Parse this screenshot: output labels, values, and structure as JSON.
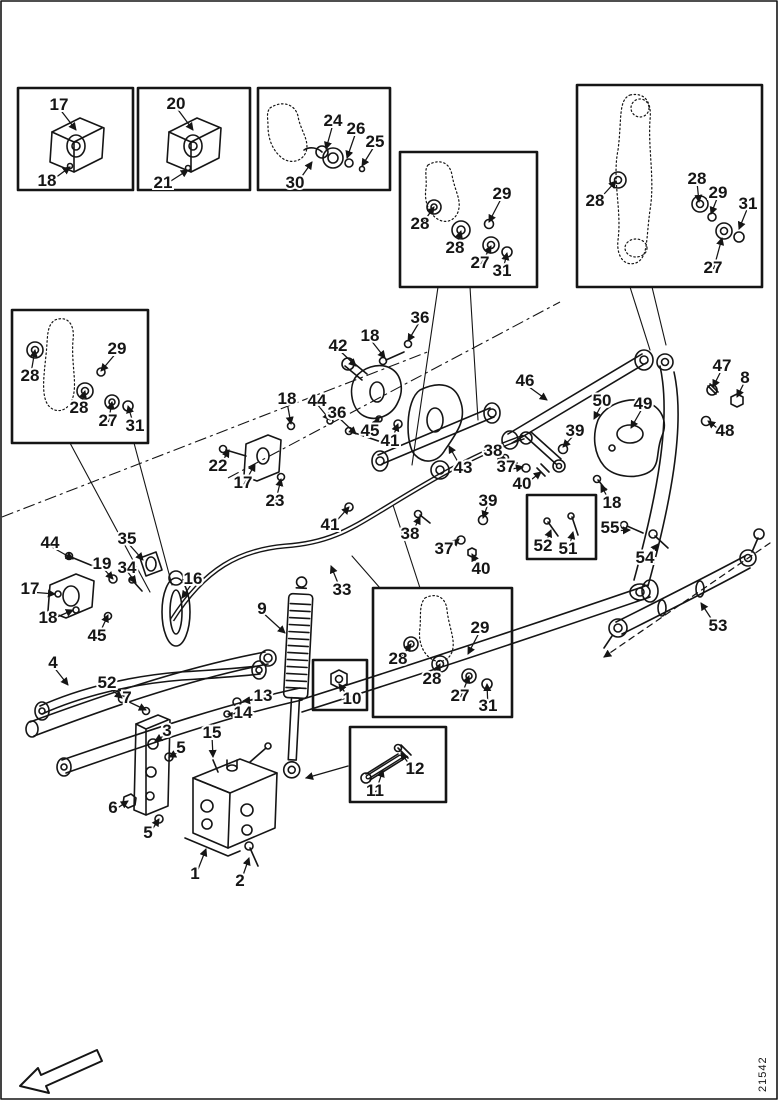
{
  "figure": {
    "number": "21542"
  },
  "colors": {
    "ink": "#151515",
    "paper": "#ffffff"
  },
  "detail_boxes": [
    {
      "name": "box-bracket-17-18",
      "parts": [
        "17",
        "18"
      ]
    },
    {
      "name": "box-bracket-20-21",
      "parts": [
        "20",
        "21"
      ]
    },
    {
      "name": "box-seal-24-26-25-30",
      "parts": [
        "24",
        "26",
        "25",
        "30"
      ]
    },
    {
      "name": "box-knuckle-top-middle",
      "parts": [
        "28",
        "29",
        "28",
        "27",
        "31"
      ]
    },
    {
      "name": "box-knuckle-top-right",
      "parts": [
        "28",
        "28",
        "29",
        "31",
        "27"
      ]
    },
    {
      "name": "box-knuckle-left",
      "parts": [
        "28",
        "29",
        "28",
        "27",
        "31"
      ]
    },
    {
      "name": "box-knuckle-middle",
      "parts": [
        "28",
        "29",
        "28",
        "27",
        "31"
      ]
    },
    {
      "name": "box-nut-10",
      "parts": [
        "10"
      ]
    },
    {
      "name": "box-bolt-11-12",
      "parts": [
        "11",
        "12"
      ]
    },
    {
      "name": "box-bolts-52-51",
      "parts": [
        "52",
        "51"
      ]
    }
  ],
  "callouts": [
    {
      "n": "17",
      "x": 59,
      "y": 104,
      "tx": 76,
      "ty": 130
    },
    {
      "n": "18",
      "x": 47,
      "y": 180,
      "tx": 70,
      "ty": 167
    },
    {
      "n": "20",
      "x": 176,
      "y": 103,
      "tx": 193,
      "ty": 130
    },
    {
      "n": "21",
      "x": 163,
      "y": 182,
      "tx": 188,
      "ty": 170
    },
    {
      "n": "24",
      "x": 333,
      "y": 120,
      "tx": 326,
      "ty": 149
    },
    {
      "n": "26",
      "x": 356,
      "y": 128,
      "tx": 347,
      "ty": 158
    },
    {
      "n": "25",
      "x": 375,
      "y": 141,
      "tx": 362,
      "ty": 166
    },
    {
      "n": "30",
      "x": 295,
      "y": 182,
      "tx": 312,
      "ty": 162
    },
    {
      "n": "28",
      "x": 420,
      "y": 223,
      "tx": 434,
      "ty": 207
    },
    {
      "n": "29",
      "x": 502,
      "y": 193,
      "tx": 489,
      "ty": 222
    },
    {
      "n": "28",
      "x": 455,
      "y": 247,
      "tx": 461,
      "ty": 231
    },
    {
      "n": "27",
      "x": 480,
      "y": 262,
      "tx": 491,
      "ty": 246
    },
    {
      "n": "31",
      "x": 502,
      "y": 270,
      "tx": 507,
      "ty": 253
    },
    {
      "n": "28",
      "x": 595,
      "y": 200,
      "tx": 616,
      "ty": 181
    },
    {
      "n": "28",
      "x": 697,
      "y": 178,
      "tx": 699,
      "ty": 202
    },
    {
      "n": "29",
      "x": 718,
      "y": 192,
      "tx": 711,
      "ty": 214
    },
    {
      "n": "31",
      "x": 748,
      "y": 203,
      "tx": 739,
      "ty": 229
    },
    {
      "n": "27",
      "x": 713,
      "y": 267,
      "tx": 722,
      "ty": 238
    },
    {
      "n": "28",
      "x": 30,
      "y": 375,
      "tx": 35,
      "ty": 350
    },
    {
      "n": "29",
      "x": 117,
      "y": 348,
      "tx": 101,
      "ty": 371
    },
    {
      "n": "28",
      "x": 79,
      "y": 407,
      "tx": 85,
      "ty": 391
    },
    {
      "n": "27",
      "x": 108,
      "y": 420,
      "tx": 112,
      "ty": 402
    },
    {
      "n": "31",
      "x": 135,
      "y": 425,
      "tx": 128,
      "ty": 406
    },
    {
      "n": "28",
      "x": 398,
      "y": 658,
      "tx": 411,
      "ty": 644
    },
    {
      "n": "29",
      "x": 480,
      "y": 627,
      "tx": 468,
      "ty": 654
    },
    {
      "n": "28",
      "x": 432,
      "y": 678,
      "tx": 440,
      "ty": 664
    },
    {
      "n": "27",
      "x": 460,
      "y": 695,
      "tx": 469,
      "ty": 676
    },
    {
      "n": "31",
      "x": 488,
      "y": 705,
      "tx": 487,
      "ty": 684
    },
    {
      "n": "10",
      "x": 352,
      "y": 698,
      "tx": 339,
      "ty": 684
    },
    {
      "n": "11",
      "x": 375,
      "y": 790,
      "tx": 383,
      "ty": 770
    },
    {
      "n": "12",
      "x": 415,
      "y": 768,
      "tx": 401,
      "ty": 753
    },
    {
      "n": "52",
      "x": 543,
      "y": 545,
      "tx": 551,
      "ty": 530
    },
    {
      "n": "51",
      "x": 568,
      "y": 548,
      "tx": 573,
      "ty": 532
    },
    {
      "n": "42",
      "x": 338,
      "y": 345,
      "tx": 356,
      "ty": 366
    },
    {
      "n": "18",
      "x": 370,
      "y": 335,
      "tx": 385,
      "ty": 358
    },
    {
      "n": "36",
      "x": 420,
      "y": 317,
      "tx": 408,
      "ty": 341
    },
    {
      "n": "18",
      "x": 287,
      "y": 398,
      "tx": 291,
      "ty": 424
    },
    {
      "n": "44",
      "x": 317,
      "y": 400,
      "tx": 330,
      "ty": 420
    },
    {
      "n": "36",
      "x": 337,
      "y": 412,
      "tx": 356,
      "ty": 434
    },
    {
      "n": "45",
      "x": 370,
      "y": 430,
      "tx": 379,
      "ty": 418
    },
    {
      "n": "41",
      "x": 390,
      "y": 440,
      "tx": 398,
      "ty": 424
    },
    {
      "n": "22",
      "x": 218,
      "y": 465,
      "tx": 229,
      "ty": 450
    },
    {
      "n": "17",
      "x": 243,
      "y": 482,
      "tx": 255,
      "ty": 464
    },
    {
      "n": "23",
      "x": 275,
      "y": 500,
      "tx": 281,
      "ty": 479
    },
    {
      "n": "43",
      "x": 463,
      "y": 467,
      "tx": 449,
      "ty": 446
    },
    {
      "n": "46",
      "x": 525,
      "y": 380,
      "tx": 547,
      "ty": 400
    },
    {
      "n": "39",
      "x": 575,
      "y": 430,
      "tx": 563,
      "ty": 447
    },
    {
      "n": "38",
      "x": 493,
      "y": 450,
      "tx": 505,
      "ty": 458
    },
    {
      "n": "37",
      "x": 506,
      "y": 466,
      "tx": 523,
      "ty": 467
    },
    {
      "n": "40",
      "x": 522,
      "y": 483,
      "tx": 541,
      "ty": 472
    },
    {
      "n": "39",
      "x": 488,
      "y": 500,
      "tx": 483,
      "ty": 518
    },
    {
      "n": "38",
      "x": 410,
      "y": 533,
      "tx": 420,
      "ty": 517
    },
    {
      "n": "37",
      "x": 444,
      "y": 548,
      "tx": 459,
      "ty": 539
    },
    {
      "n": "40",
      "x": 481,
      "y": 568,
      "tx": 472,
      "ty": 554
    },
    {
      "n": "41",
      "x": 330,
      "y": 524,
      "tx": 349,
      "ty": 507
    },
    {
      "n": "33",
      "x": 342,
      "y": 589,
      "tx": 331,
      "ty": 566
    },
    {
      "n": "9",
      "x": 262,
      "y": 608,
      "tx": 285,
      "ty": 633
    },
    {
      "n": "16",
      "x": 193,
      "y": 578,
      "tx": 182,
      "ty": 598
    },
    {
      "n": "35",
      "x": 127,
      "y": 538,
      "tx": 143,
      "ty": 560
    },
    {
      "n": "19",
      "x": 102,
      "y": 563,
      "tx": 113,
      "ty": 579
    },
    {
      "n": "34",
      "x": 127,
      "y": 567,
      "tx": 136,
      "ty": 583
    },
    {
      "n": "44",
      "x": 50,
      "y": 542,
      "tx": 73,
      "ty": 559
    },
    {
      "n": "17",
      "x": 30,
      "y": 588,
      "tx": 55,
      "ty": 594
    },
    {
      "n": "18",
      "x": 48,
      "y": 617,
      "tx": 73,
      "ty": 610
    },
    {
      "n": "45",
      "x": 97,
      "y": 635,
      "tx": 108,
      "ty": 615
    },
    {
      "n": "4",
      "x": 53,
      "y": 662,
      "tx": 68,
      "ty": 685
    },
    {
      "n": "52",
      "x": 107,
      "y": 682,
      "tx": 122,
      "ty": 698
    },
    {
      "n": "7",
      "x": 127,
      "y": 697,
      "tx": 146,
      "ty": 710
    },
    {
      "n": "13",
      "x": 263,
      "y": 695,
      "tx": 243,
      "ty": 701
    },
    {
      "n": "14",
      "x": 243,
      "y": 712,
      "tx": 228,
      "ty": 714
    },
    {
      "n": "3",
      "x": 167,
      "y": 730,
      "tx": 155,
      "ty": 741
    },
    {
      "n": "5",
      "x": 181,
      "y": 747,
      "tx": 169,
      "ty": 757
    },
    {
      "n": "15",
      "x": 212,
      "y": 732,
      "tx": 213,
      "ty": 757
    },
    {
      "n": "6",
      "x": 113,
      "y": 807,
      "tx": 128,
      "ty": 801
    },
    {
      "n": "5",
      "x": 148,
      "y": 832,
      "tx": 159,
      "ty": 819
    },
    {
      "n": "1",
      "x": 195,
      "y": 873,
      "tx": 206,
      "ty": 849
    },
    {
      "n": "2",
      "x": 240,
      "y": 880,
      "tx": 249,
      "ty": 858
    },
    {
      "n": "50",
      "x": 602,
      "y": 400,
      "tx": 594,
      "ty": 419
    },
    {
      "n": "49",
      "x": 643,
      "y": 403,
      "tx": 631,
      "ty": 428
    },
    {
      "n": "47",
      "x": 722,
      "y": 365,
      "tx": 713,
      "ty": 387
    },
    {
      "n": "8",
      "x": 745,
      "y": 377,
      "tx": 737,
      "ty": 397
    },
    {
      "n": "48",
      "x": 725,
      "y": 430,
      "tx": 708,
      "ty": 421
    },
    {
      "n": "18",
      "x": 612,
      "y": 502,
      "tx": 601,
      "ty": 485
    },
    {
      "n": "55",
      "x": 610,
      "y": 527,
      "tx": 630,
      "ty": 530
    },
    {
      "n": "54",
      "x": 645,
      "y": 557,
      "tx": 658,
      "ty": 544
    },
    {
      "n": "53",
      "x": 718,
      "y": 625,
      "tx": 701,
      "ty": 603
    }
  ]
}
